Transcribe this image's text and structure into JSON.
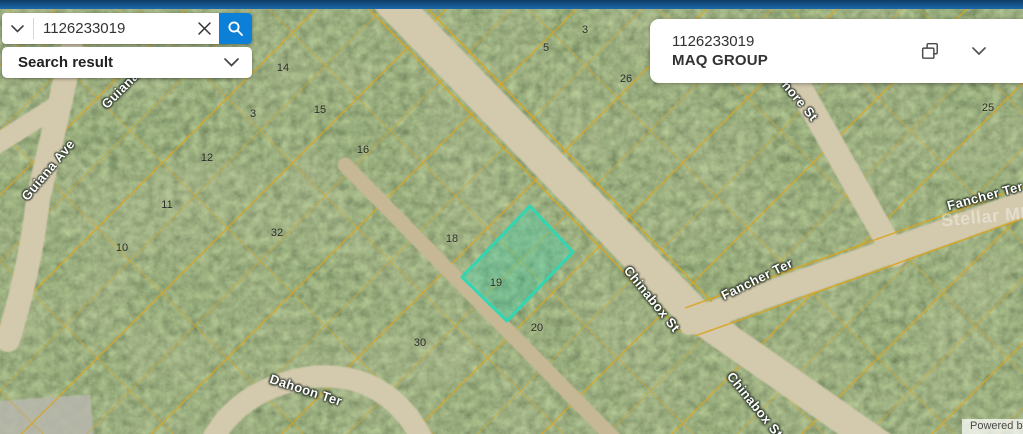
{
  "colors": {
    "top-bar": "#1d67ad",
    "accent": "#0c7fd6",
    "parcel-line": "#d9a51f",
    "parcel-highlight-stroke": "#2fd7b2",
    "parcel-highlight-fill": "rgba(46,215,178,0.30)"
  },
  "search": {
    "value": "1126233019",
    "result_label": "Search result",
    "icons": [
      "chevron-down-icon",
      "clear-x-icon",
      "magnifier-icon"
    ]
  },
  "result_panel": {
    "parcel_id": "1126233019",
    "owner": "MAQ GROUP",
    "icons": [
      "copy-icon",
      "chevron-down-icon"
    ]
  },
  "map": {
    "watermark": "Stellar MLS",
    "attribution": "Powered by Esri",
    "selected_parcel": {
      "points": "530,206 573,252 507,321 462,277"
    },
    "street_labels": [
      {
        "text": "Guiana Ave",
        "x": 48,
        "y": 170,
        "rot": -50
      },
      {
        "text": "Guiana Ave",
        "x": 130,
        "y": 80,
        "rot": -45
      },
      {
        "text": "Dahoon Ter",
        "x": 306,
        "y": 390,
        "rot": 18
      },
      {
        "text": "Chinabox St",
        "x": 652,
        "y": 299,
        "rot": 51
      },
      {
        "text": "Fancher Ter",
        "x": 757,
        "y": 279,
        "rot": -26
      },
      {
        "text": "Fancher Ter",
        "x": 985,
        "y": 196,
        "rot": -15
      },
      {
        "text": "hore St",
        "x": 800,
        "y": 101,
        "rot": 50
      },
      {
        "text": "Chinabox St",
        "x": 755,
        "y": 405,
        "rot": 51
      }
    ],
    "parcel_numbers": [
      {
        "text": "14",
        "x": 283,
        "y": 68
      },
      {
        "text": "15",
        "x": 320,
        "y": 110
      },
      {
        "text": "16",
        "x": 363,
        "y": 150
      },
      {
        "text": "3",
        "x": 253,
        "y": 114
      },
      {
        "text": "5",
        "x": 546,
        "y": 48
      },
      {
        "text": "3",
        "x": 585,
        "y": 30
      },
      {
        "text": "26",
        "x": 626,
        "y": 79
      },
      {
        "text": "12",
        "x": 207,
        "y": 158
      },
      {
        "text": "11",
        "x": 167,
        "y": 205
      },
      {
        "text": "10",
        "x": 122,
        "y": 248
      },
      {
        "text": "32",
        "x": 277,
        "y": 233
      },
      {
        "text": "18",
        "x": 452,
        "y": 239
      },
      {
        "text": "19",
        "x": 496,
        "y": 283
      },
      {
        "text": "20",
        "x": 537,
        "y": 328
      },
      {
        "text": "30",
        "x": 420,
        "y": 343
      },
      {
        "text": "25",
        "x": 988,
        "y": 108
      }
    ]
  }
}
